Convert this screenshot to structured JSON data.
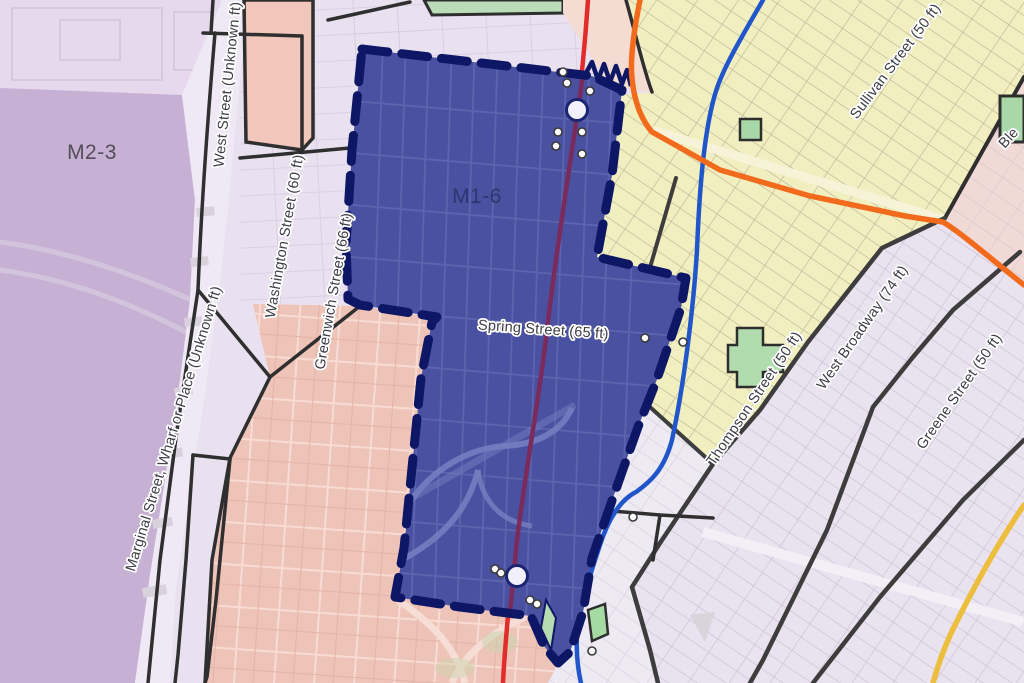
{
  "map": {
    "district_labels": [
      {
        "id": "m2-3",
        "text": "M2-3"
      },
      {
        "id": "m1-6",
        "text": "M1-6"
      }
    ],
    "street_labels": [
      {
        "id": "west-street",
        "text": "West Street  (Unknown ft)"
      },
      {
        "id": "washington-street",
        "text": "Washington Street  (60 ft)"
      },
      {
        "id": "greenwich-street",
        "text": "Greenwich Street  (66 ft)"
      },
      {
        "id": "marginal-street",
        "text": "Marginal Street, Wharf or Place  (Unknown ft)"
      },
      {
        "id": "spring-street",
        "text": "Spring Street   (65 ft)"
      },
      {
        "id": "sullivan-street",
        "text": "Sullivan Street  (50 ft)"
      },
      {
        "id": "thompson-street",
        "text": "Thompson Street  (50 ft)"
      },
      {
        "id": "west-broadway",
        "text": "West Broadway  (74 ft)"
      },
      {
        "id": "greene-street",
        "text": "Greene Street  (50 ft)"
      },
      {
        "id": "bleecker-partial",
        "text": "Ble"
      }
    ],
    "colors": {
      "selected_district_fill": "#4a51a0",
      "selected_district_border": "#0e1765",
      "zone_purple": "#c6b1d4",
      "zone_lavender": "#e9e1f0",
      "zone_pink": "#eec3b8",
      "zone_yellow": "#f1eebf",
      "zone_park_green": "#aed9ab",
      "line_red": "#e22b2b",
      "line_blue": "#2156cb",
      "line_orange": "#f26a1b",
      "line_yellow": "#edbe3e",
      "boundary_black": "#2f2f2f"
    }
  }
}
